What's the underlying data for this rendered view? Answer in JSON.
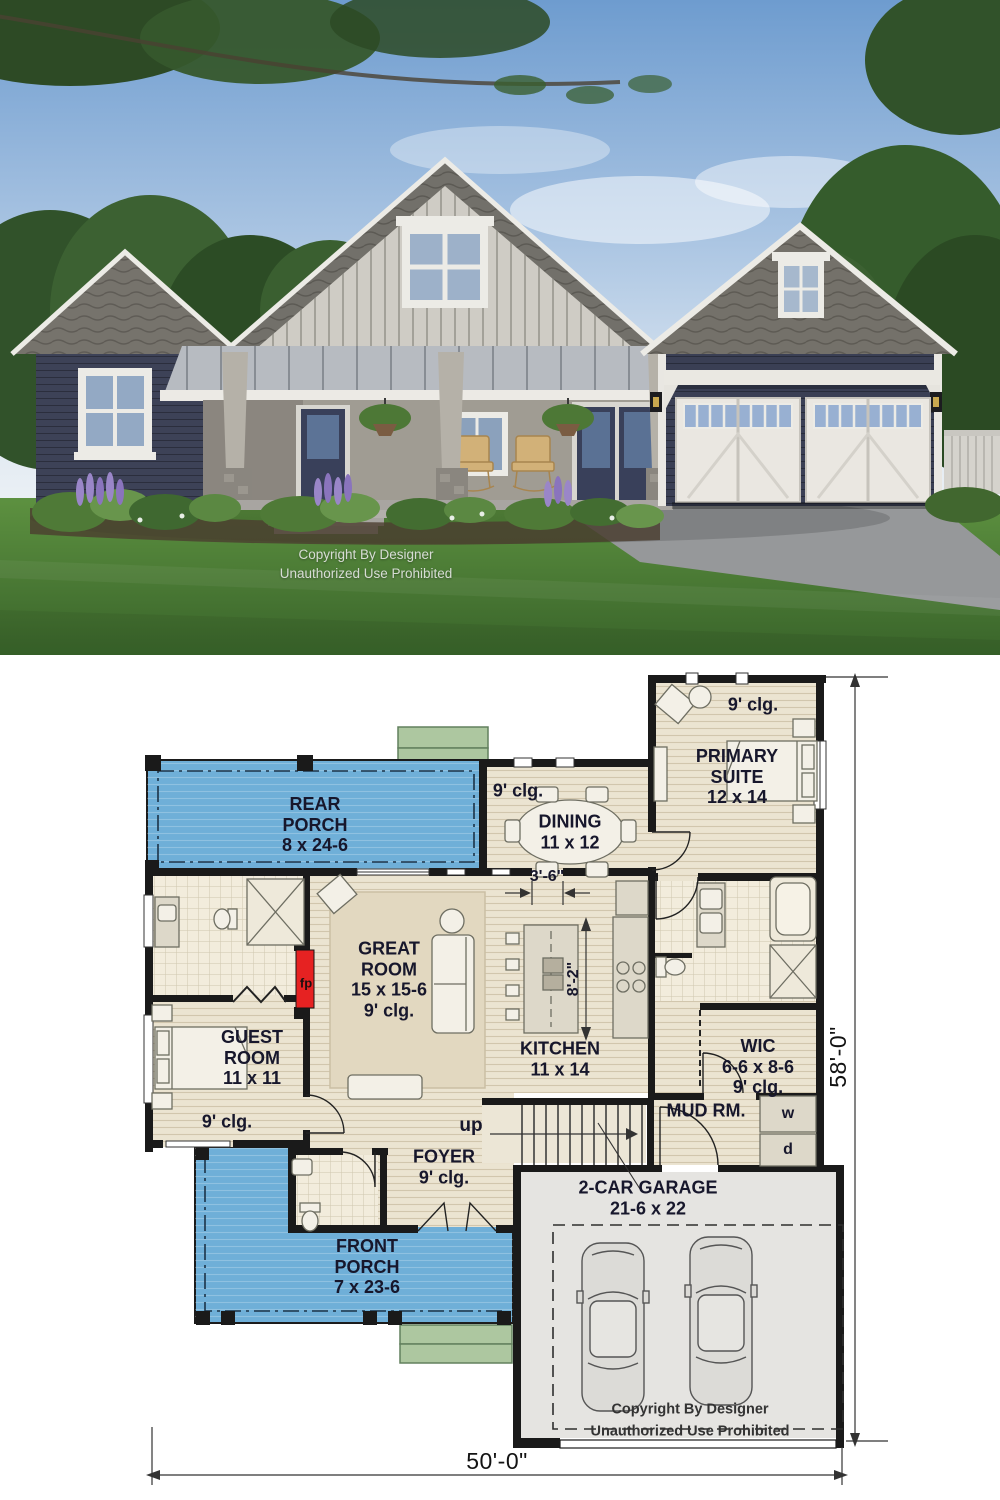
{
  "photo": {
    "copyright": {
      "line1": "Copyright By Designer",
      "line2": "Unauthorized Use Prohibited"
    }
  },
  "plan": {
    "rooms": {
      "rear_porch": {
        "name": "REAR\nPORCH",
        "size": "8 x 24-6"
      },
      "dining": {
        "name": "DINING",
        "size": "11 x 12",
        "ceiling": "9' clg."
      },
      "primary_suite": {
        "name": "PRIMARY\nSUITE",
        "size": "12 x 14",
        "ceiling": "9' clg."
      },
      "great_room": {
        "name": "GREAT\nROOM",
        "size": "15 x 15-6",
        "ceiling": "9' clg."
      },
      "guest_room": {
        "name": "GUEST\nROOM",
        "size": "11 x 11",
        "ceiling": "9' clg."
      },
      "kitchen": {
        "name": "KITCHEN",
        "size": "11 x 14"
      },
      "wic": {
        "name": "WIC",
        "size": "6-6 x 8-6",
        "ceiling": "9' clg."
      },
      "mud_room": {
        "name": "MUD RM."
      },
      "foyer": {
        "name": "FOYER",
        "ceiling": "9' clg."
      },
      "front_porch": {
        "name": "FRONT\nPORCH",
        "size": "7 x 23-6"
      },
      "garage": {
        "name": "2-CAR GARAGE",
        "size": "21-6 x 22"
      }
    },
    "labels": {
      "stairs_up": "up",
      "fireplace": "fp",
      "washer": "w",
      "dryer": "d"
    },
    "dimensions": {
      "overall_width": "50'-0\"",
      "overall_depth": "58'-0\"",
      "kitchen_clearance": "8'-2\"",
      "passage_width": "3'-6\""
    },
    "copyright": {
      "line1": "Copyright By Designer",
      "line2": "Unauthorized Use Prohibited"
    },
    "colors": {
      "porch": "#6fafd8",
      "floor": "#ebe4d1",
      "wall": "#1a1a1a",
      "fireplace": "#e62222",
      "steps": "#adc7a0"
    }
  }
}
